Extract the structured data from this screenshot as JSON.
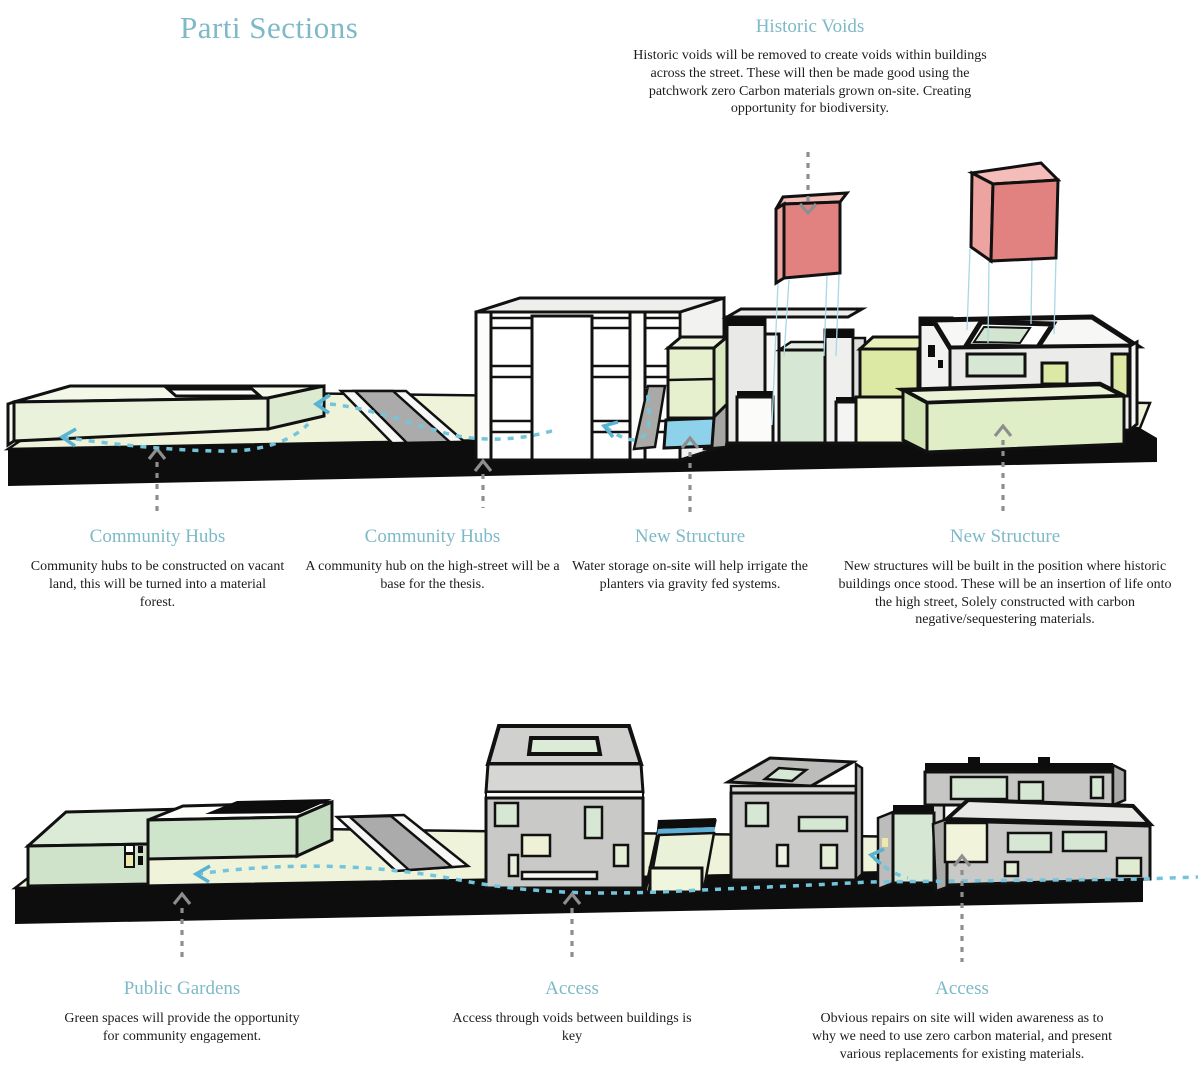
{
  "title": "Parti Sections",
  "colors": {
    "heading_teal": "#7db9c7",
    "body_text": "#1c1c1c",
    "ground": "#eef3da",
    "road_gray": "#ababab",
    "base_black": "#0d0d0d",
    "mint": "#d6e8d4",
    "pale_green": "#e0eec8",
    "yellow_green": "#dce9a4",
    "water": "#8ed1ea",
    "void_cube": "#e28280",
    "void_cube_side": "#eda3a0",
    "void_cube_top": "#f4bdb9",
    "gray_wall": "#c9c9c7",
    "arrow_gray": "#8e8e8e",
    "arrow_blue": "#74c4dc"
  },
  "historic_voids": {
    "heading": "Historic Voids",
    "body": "Historic voids will be removed to create voids within buildings across the street. These will then be made good using the patchwork zero Carbon materials grown on-site. Creating opportunity for biodiversity."
  },
  "top_section": {
    "annotations": [
      {
        "heading": "Community Hubs",
        "body": "Community hubs to be constructed on vacant land, this will be turned into a material forest."
      },
      {
        "heading": "Community Hubs",
        "body": "A community hub on the high-street will be a base for the thesis."
      },
      {
        "heading": "New Structure",
        "body": "Water storage on-site will help irrigate the planters via gravity fed systems."
      },
      {
        "heading": "New Structure",
        "body": "New structures will be built in the position where historic buildings once stood. These will be an insertion of life onto the high street, Solely constructed with carbon negative/sequestering materials."
      }
    ]
  },
  "bottom_section": {
    "annotations": [
      {
        "heading": "Public Gardens",
        "body": "Green spaces will provide the opportunity for community engagement."
      },
      {
        "heading": "Access",
        "body": "Access through voids between buildings is key"
      },
      {
        "heading": "Access",
        "body": "Obvious repairs on site will widen awareness as to why we need to use zero carbon material, and present various replacements for existing materials."
      }
    ]
  }
}
